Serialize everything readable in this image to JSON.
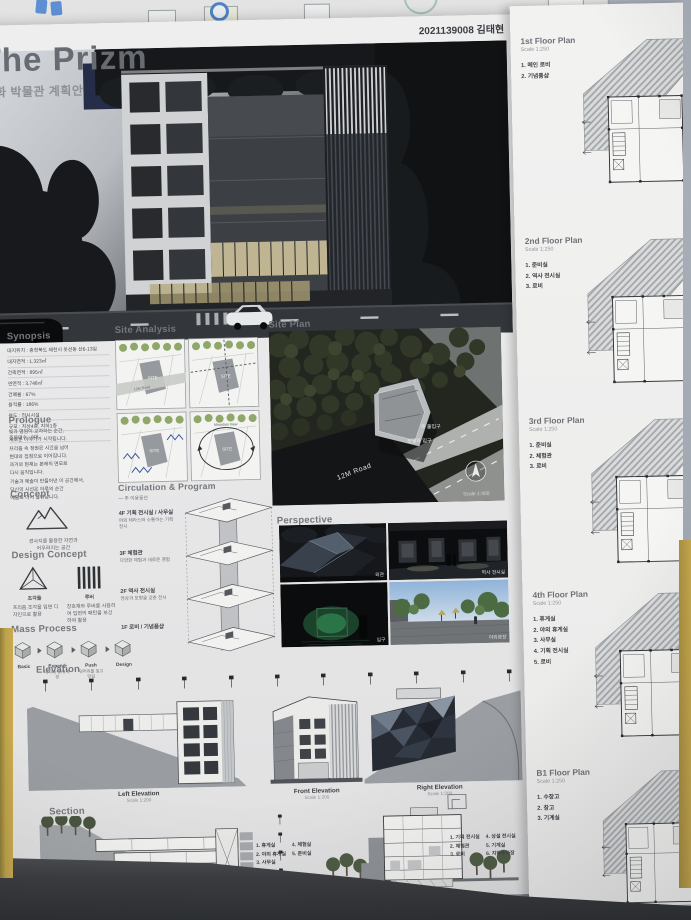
{
  "colors": {
    "wall": "#aeb4bd",
    "trim": "#bfa24a",
    "paper": "#ebebec",
    "tab_blue": "#5d8fd2",
    "tree_green": "#8fa768"
  },
  "poster": {
    "header": {
      "title": "The Prizm",
      "subtitle": "문화 박물관 계획안",
      "student_id": "2021139008 김태현"
    },
    "synopsis": {
      "heading": "Synopsis",
      "items": [
        "대지위치 : 충청북도 제천시 옷선동 산6-13일",
        "대지면적 : 1,323㎡",
        "건축면적 : 895㎡",
        "연면적 : 3,748㎡",
        "건폐율 : 67%",
        "용적률 : 186%",
        "용도 : 전시시설",
        "규모 : 지상4층, 지하1층",
        "주차대수 : 8대"
      ]
    },
    "prologue": {
      "heading": "Prologue",
      "lines": [
        "빛과 명암이 교차하는 순간,",
        "새로운 이야기가 시작됩니다.",
        "프리즘 속 정원은 시간을 넘어",
        "현대와 접점으로 이어집니다.",
        "과거와 현재는 본래의 면모로",
        "다시 움직입니다.",
        "기술과 예술이 만들어낸 이 공간에서,",
        "당신의 시선은 하루의 순간",
        "예술로 다시 살아납니다."
      ]
    },
    "concept": {
      "heading": "Concept",
      "caption_line1": "경사지를 활용한 자연과",
      "caption_line2": "어우러지는 공간"
    },
    "design_concept": {
      "heading": "Design Concept",
      "prism": {
        "label": "조각들",
        "caption": "프리즘 조각을 입면 디자인으로 활용"
      },
      "louver": {
        "label": "루버",
        "caption": "창호재와 루버를 사용하여 입면의 패턴을 보강하여 활용"
      }
    },
    "mass_process": {
      "heading": "Mass Process",
      "steps": [
        {
          "label": "Basic",
          "caption": ""
        },
        {
          "label": "Expand",
          "caption": "대지에 맞게 확장"
        },
        {
          "label": "Push",
          "caption": "덩어리를 밀고 당김"
        },
        {
          "label": "Design",
          "caption": ""
        }
      ]
    },
    "site_analysis": {
      "heading": "Site Analysis",
      "site_label": "SITE",
      "road_label": "12M Road",
      "view_label": "Mountain View"
    },
    "circulation": {
      "heading": "Circulation & Program",
      "legend": "— 주 이용동선",
      "floors": [
        {
          "name": "4F 기획 전시실 / 사무실",
          "desc": "야외 테라스와 소통하는 기획 전시"
        },
        {
          "name": "3F 체험관",
          "desc": "다양한 체험과 새로운 경험"
        },
        {
          "name": "2F 역사 전시실",
          "desc": "영상과 모형을 갖춘 전시"
        },
        {
          "name": "1F 로비 / 기념품샵",
          "desc": ""
        }
      ]
    },
    "site_plan": {
      "heading": "Site Plan",
      "road_label": "12M Road",
      "main_entrance_label": "주 출입구",
      "ped_entrance_label": "보행자 입구",
      "scale": "Scale 1:400"
    },
    "perspective": {
      "heading": "Perspective",
      "captions": [
        "외관",
        "역사 전시실",
        "입구",
        "야외광장"
      ]
    },
    "elevation": {
      "heading": "Elevation",
      "drawings": [
        {
          "name": "Left Elevation",
          "scale": "Scale 1:200"
        },
        {
          "name": "Front Elevation",
          "scale": "Scale 1:200"
        },
        {
          "name": "Right Elevation",
          "scale": "Scale 1:200"
        }
      ]
    },
    "section": {
      "heading": "Section",
      "drawings": [
        {
          "name": "A-A' Section",
          "scale": "Scale 1:200"
        },
        {
          "name": "B-B' Section",
          "scale": "Scale 1:200"
        }
      ],
      "legend_left": [
        "1. 휴게실",
        "2. 야외 휴게실",
        "3. 사무실",
        "4. 체험실",
        "5. 준비실"
      ],
      "legend_right": [
        "1. 기획 전시실",
        "2. 체험관",
        "3. 로비",
        "4. 상설 전시실",
        "5. 기계실",
        "6. 지하주차장"
      ]
    },
    "floor_plans": [
      {
        "name": "1st Floor Plan",
        "scale": "Scale 1:250",
        "rooms": [
          "1. 메인 로비",
          "2. 기념품샵"
        ]
      },
      {
        "name": "2nd Floor Plan",
        "scale": "Scale 1:250",
        "rooms": [
          "1. 준비실",
          "2. 역사 전시실",
          "3. 로비"
        ]
      },
      {
        "name": "3rd Floor Plan",
        "scale": "Scale 1:250",
        "rooms": [
          "1. 준비실",
          "2. 체험관",
          "3. 로비"
        ]
      },
      {
        "name": "4th Floor Plan",
        "scale": "Scale 1:250",
        "rooms": [
          "1. 휴게실",
          "2. 야외 휴게실",
          "3. 사무실",
          "4. 기획 전시실",
          "5. 로비"
        ]
      },
      {
        "name": "B1 Floor Plan",
        "scale": "Scale 1:250",
        "rooms": [
          "1. 수장고",
          "2. 창고",
          "3. 기계실"
        ]
      }
    ]
  }
}
